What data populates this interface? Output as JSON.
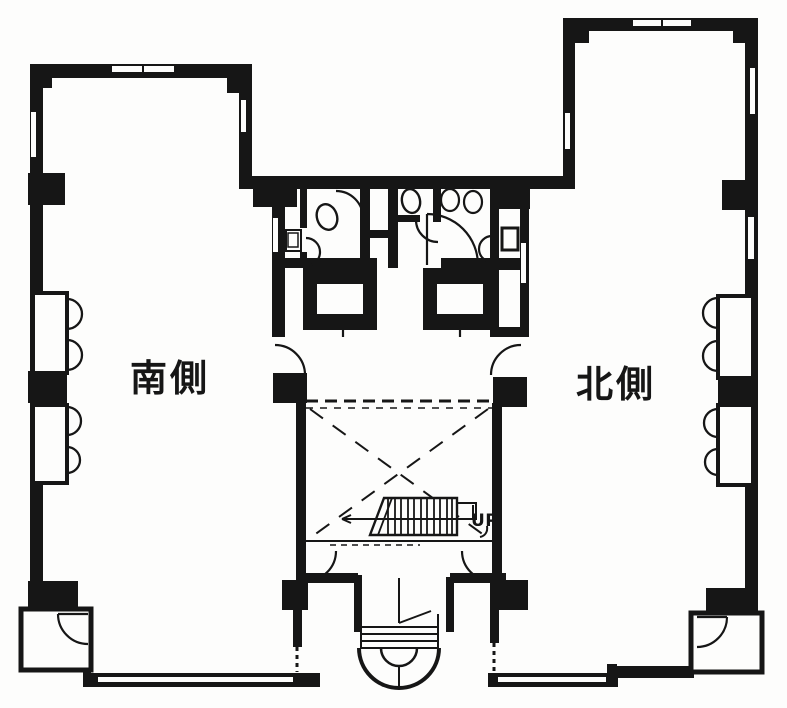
{
  "plan": {
    "south_wing_label": "南側",
    "north_wing_label": "北側",
    "stair_up_label": "UP",
    "ink_color": "#161616",
    "paper_color": "#fdfdfc"
  }
}
